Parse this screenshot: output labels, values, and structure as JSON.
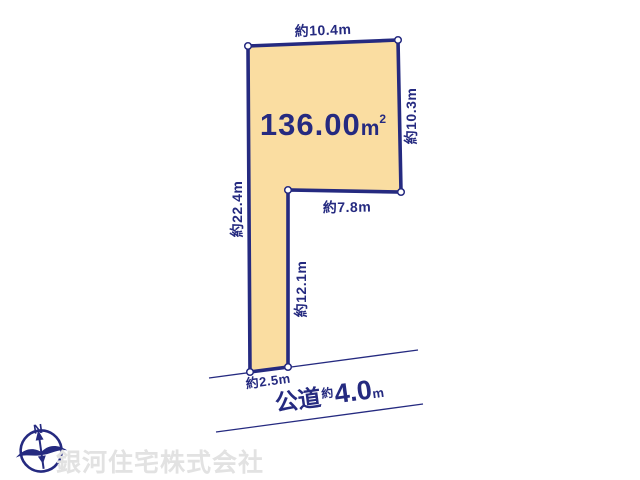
{
  "diagram": {
    "title_area": {
      "value": "136.00",
      "unit": "m",
      "sup": "2"
    },
    "dimensions": {
      "top": "約10.4m",
      "right": "約10.3m",
      "left": "約22.4m",
      "middle": "約7.8m",
      "pole_right": "約12.1m",
      "bottom": "約2.5m"
    },
    "road": {
      "name": "公道",
      "approx": "約",
      "value": "4.0",
      "unit": "m"
    },
    "compass": {
      "north_label": "N"
    },
    "watermark": "銀河住宅株式会社",
    "colors": {
      "plot_fill": "#fadda1",
      "line_navy": "#252a80",
      "watermark_gray": "#e2e2e2",
      "corner_marker_fill": "#ffffff"
    }
  }
}
